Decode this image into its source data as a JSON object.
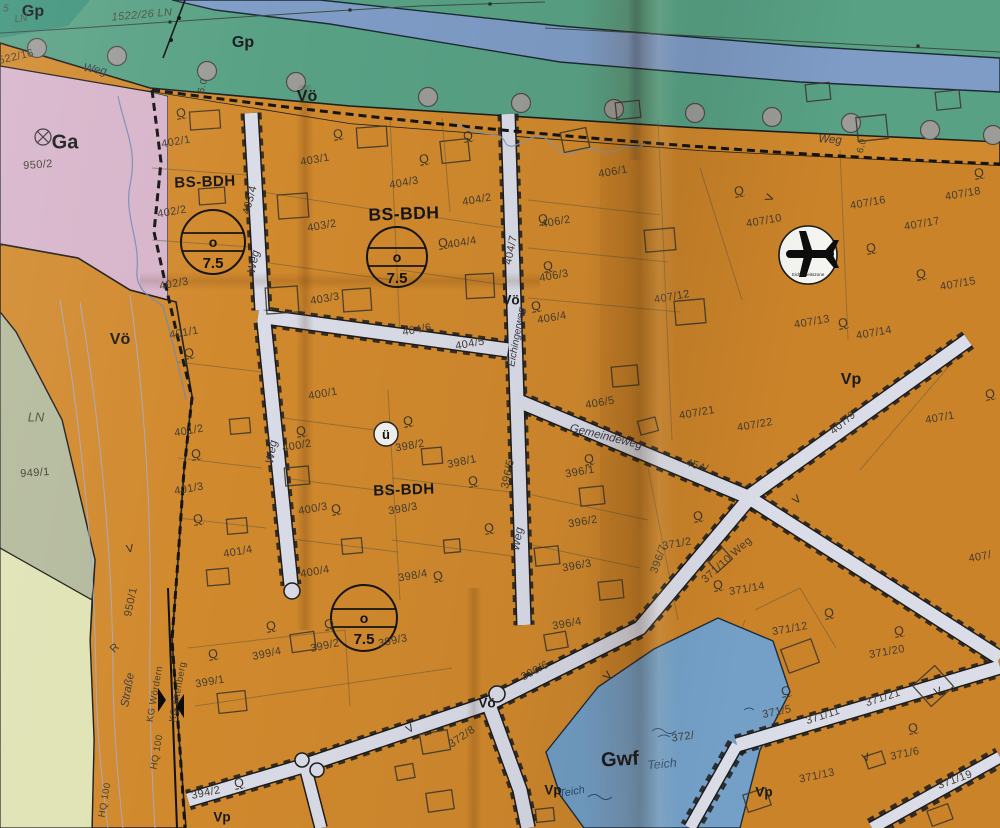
{
  "map_type": "Bebauungsplan / cadastral zoning map (paper, photographed)",
  "colors": {
    "green": "#58a185",
    "river": "#7e9cc6",
    "roadtop": "#e4e5e9",
    "pink": "#d7b4ca",
    "lav": "#c8cbdf",
    "ln1": "#b4ba9c",
    "ln2": "#dfe3b4",
    "orange": "#d1892d",
    "pond": "#74a0c8",
    "street": "#dadce8"
  },
  "symbols": {
    "airplane": {
      "x": 808,
      "y": 255,
      "r": 29,
      "caption": "Sicherheitszone"
    },
    "u_circle": {
      "x": 386,
      "y": 434,
      "r": 12,
      "text": "ü"
    },
    "use_templates": [
      {
        "x": 213,
        "y": 242,
        "r": 32,
        "mid": "o",
        "bottom": "7.5"
      },
      {
        "x": 397,
        "y": 257,
        "r": 30,
        "mid": "o",
        "bottom": "7.5"
      },
      {
        "x": 364,
        "y": 618,
        "r": 33,
        "mid": "o",
        "bottom": "7.5"
      }
    ]
  },
  "trees": [
    [
      37,
      48
    ],
    [
      117,
      56
    ],
    [
      207,
      71
    ],
    [
      296,
      82
    ],
    [
      428,
      97
    ],
    [
      521,
      103
    ],
    [
      614,
      109
    ],
    [
      695,
      113
    ],
    [
      772,
      117
    ],
    [
      851,
      123
    ],
    [
      930,
      130
    ],
    [
      993,
      135
    ]
  ],
  "labels": [
    {
      "t": "Gp",
      "x": 33,
      "y": 12,
      "r": 0,
      "c": "zb",
      "n": "zone-label-gp"
    },
    {
      "t": "Gp",
      "x": 243,
      "y": 43,
      "r": 0,
      "c": "zb",
      "n": "zone-label-gp"
    },
    {
      "t": "Vö",
      "x": 307,
      "y": 97,
      "r": 0,
      "c": "zb",
      "n": "zone-label-voe"
    },
    {
      "t": "Ga",
      "x": 65,
      "y": 143,
      "r": 0,
      "c": "zb zb-lg",
      "n": "zone-label-ga"
    },
    {
      "t": "Vö",
      "x": 120,
      "y": 340,
      "r": 0,
      "c": "zb",
      "n": "zone-label-voe"
    },
    {
      "t": "Vö",
      "x": 511,
      "y": 300,
      "r": 0,
      "c": "zb zb-sm",
      "n": "zone-label-voe"
    },
    {
      "t": "Vö",
      "x": 487,
      "y": 703,
      "r": 0,
      "c": "zb zb-sm",
      "n": "zone-label-voe"
    },
    {
      "t": "Vp",
      "x": 851,
      "y": 380,
      "r": 0,
      "c": "zb",
      "n": "zone-label-vp"
    },
    {
      "t": "Vp",
      "x": 764,
      "y": 792,
      "r": 0,
      "c": "zb zb-sm",
      "n": "zone-label-vp"
    },
    {
      "t": "Vp",
      "x": 553,
      "y": 790,
      "r": 0,
      "c": "zb zb-sm",
      "n": "zone-label-vp"
    },
    {
      "t": "Vp",
      "x": 222,
      "y": 817,
      "r": 0,
      "c": "zb zb-sm",
      "n": "zone-label-vp"
    },
    {
      "t": "Gwf",
      "x": 620,
      "y": 760,
      "r": -3,
      "c": "zb zb-lg",
      "n": "zone-label-gwf"
    },
    {
      "t": "BS-BDH",
      "x": 205,
      "y": 182,
      "r": -2,
      "c": "bs",
      "n": "zone-label-bs-bdh"
    },
    {
      "t": "BS-BDH",
      "x": 404,
      "y": 214,
      "r": -2,
      "c": "bs bs-lg",
      "n": "zone-label-bs-bdh"
    },
    {
      "t": "BS-BDH",
      "x": 404,
      "y": 490,
      "r": -2,
      "c": "bs",
      "n": "zone-label-bs-bdh"
    },
    {
      "t": "LN",
      "x": 36,
      "y": 417,
      "r": 0,
      "c": "ln",
      "n": "zone-label-ln"
    },
    {
      "t": "5",
      "x": 6,
      "y": 9,
      "r": 0,
      "c": "ln ln-sm",
      "n": "zone-label-ln"
    },
    {
      "t": "LN",
      "x": 21,
      "y": 19,
      "r": -8,
      "c": "ln ln-sm",
      "n": "zone-label-ln"
    },
    {
      "t": "1522/26 LN",
      "x": 142,
      "y": 15,
      "r": -5,
      "c": "p pi",
      "n": "parcel-label"
    },
    {
      "t": "522/16",
      "x": 16,
      "y": 57,
      "r": -13,
      "c": "p",
      "n": "parcel-label"
    },
    {
      "t": "950/2",
      "x": 38,
      "y": 165,
      "r": -4,
      "c": "p",
      "n": "parcel-label"
    },
    {
      "t": "949/1",
      "x": 35,
      "y": 473,
      "r": -4,
      "c": "p",
      "n": "parcel-label"
    },
    {
      "t": "950/1",
      "x": 131,
      "y": 602,
      "r": -78,
      "c": "p",
      "n": "parcel-label"
    },
    {
      "t": "Straße",
      "x": 128,
      "y": 690,
      "r": -80,
      "c": "sn",
      "n": "street-name"
    },
    {
      "t": "R",
      "x": 115,
      "y": 648,
      "r": -45,
      "c": "p",
      "n": "parcel-label"
    },
    {
      "t": "HQ 100",
      "x": 157,
      "y": 752,
      "r": -80,
      "c": "p psm",
      "n": "flood-line-label"
    },
    {
      "t": "HQ 100",
      "x": 105,
      "y": 800,
      "r": -80,
      "c": "p psm",
      "n": "flood-line-label"
    },
    {
      "t": "KG Wördern",
      "x": 155,
      "y": 694,
      "r": -80,
      "c": "p psm",
      "n": "cadastral-boundary-label"
    },
    {
      "t": "KG Altenberg",
      "x": 178,
      "y": 692,
      "r": -80,
      "c": "p psm",
      "n": "cadastral-boundary-label"
    },
    {
      "t": "Weg",
      "x": 95,
      "y": 70,
      "r": 10,
      "c": "sn",
      "n": "street-name"
    },
    {
      "t": "Weg",
      "x": 830,
      "y": 140,
      "r": 4,
      "c": "sn",
      "n": "street-name"
    },
    {
      "t": "6.0",
      "x": 203,
      "y": 86,
      "r": -75,
      "c": "p psm",
      "n": "dimension-label"
    },
    {
      "t": "6.0",
      "x": 862,
      "y": 146,
      "r": -75,
      "c": "p psm",
      "n": "dimension-label"
    },
    {
      "t": "402/1",
      "x": 176,
      "y": 142,
      "r": -10,
      "c": "p",
      "n": "parcel-label"
    },
    {
      "t": "402/2",
      "x": 172,
      "y": 212,
      "r": -10,
      "c": "p",
      "n": "parcel-label"
    },
    {
      "t": "402/3",
      "x": 174,
      "y": 284,
      "r": -10,
      "c": "p",
      "n": "parcel-label"
    },
    {
      "t": "403/4",
      "x": 250,
      "y": 200,
      "r": -75,
      "c": "p",
      "n": "parcel-label"
    },
    {
      "t": "Weg",
      "x": 254,
      "y": 262,
      "r": -78,
      "c": "sn",
      "n": "street-name"
    },
    {
      "t": "401/1",
      "x": 184,
      "y": 333,
      "r": -10,
      "c": "p",
      "n": "parcel-label"
    },
    {
      "t": "401/2",
      "x": 189,
      "y": 431,
      "r": -10,
      "c": "p",
      "n": "parcel-label"
    },
    {
      "t": "401/3",
      "x": 189,
      "y": 489,
      "r": -10,
      "c": "p",
      "n": "parcel-label"
    },
    {
      "t": "401/4",
      "x": 238,
      "y": 552,
      "r": -10,
      "c": "p",
      "n": "parcel-label"
    },
    {
      "t": "Weg",
      "x": 272,
      "y": 452,
      "r": -80,
      "c": "sn",
      "n": "street-name"
    },
    {
      "t": "403/1",
      "x": 315,
      "y": 160,
      "r": -10,
      "c": "p",
      "n": "parcel-label"
    },
    {
      "t": "403/2",
      "x": 322,
      "y": 226,
      "r": -10,
      "c": "p",
      "n": "parcel-label"
    },
    {
      "t": "403/3",
      "x": 325,
      "y": 299,
      "r": -10,
      "c": "p",
      "n": "parcel-label"
    },
    {
      "t": "404/3",
      "x": 404,
      "y": 183,
      "r": -10,
      "c": "p",
      "n": "parcel-label"
    },
    {
      "t": "404/2",
      "x": 477,
      "y": 200,
      "r": -10,
      "c": "p",
      "n": "parcel-label"
    },
    {
      "t": "404/4",
      "x": 462,
      "y": 243,
      "r": -10,
      "c": "p",
      "n": "parcel-label"
    },
    {
      "t": "404/6",
      "x": 417,
      "y": 330,
      "r": -10,
      "c": "p",
      "n": "parcel-label"
    },
    {
      "t": "404/5",
      "x": 470,
      "y": 344,
      "r": -10,
      "c": "p",
      "n": "parcel-label"
    },
    {
      "t": "404/7",
      "x": 511,
      "y": 250,
      "r": -78,
      "c": "p",
      "n": "parcel-label"
    },
    {
      "t": "Eichingerweg",
      "x": 517,
      "y": 337,
      "r": -80,
      "c": "sn sn-sm",
      "n": "street-name"
    },
    {
      "t": "406/1",
      "x": 613,
      "y": 172,
      "r": -10,
      "c": "p",
      "n": "parcel-label"
    },
    {
      "t": "406/2",
      "x": 556,
      "y": 222,
      "r": -10,
      "c": "p",
      "n": "parcel-label"
    },
    {
      "t": "406/3",
      "x": 554,
      "y": 276,
      "r": -10,
      "c": "p",
      "n": "parcel-label"
    },
    {
      "t": "406/4",
      "x": 552,
      "y": 318,
      "r": -10,
      "c": "p",
      "n": "parcel-label"
    },
    {
      "t": "406/5",
      "x": 600,
      "y": 403,
      "r": -10,
      "c": "p",
      "n": "parcel-label"
    },
    {
      "t": "407/12",
      "x": 672,
      "y": 297,
      "r": -10,
      "c": "p",
      "n": "parcel-label"
    },
    {
      "t": "407/10",
      "x": 764,
      "y": 221,
      "r": -10,
      "c": "p",
      "n": "parcel-label"
    },
    {
      "t": "407/16",
      "x": 868,
      "y": 203,
      "r": -10,
      "c": "p",
      "n": "parcel-label"
    },
    {
      "t": "407/17",
      "x": 922,
      "y": 224,
      "r": -10,
      "c": "p",
      "n": "parcel-label"
    },
    {
      "t": "407/18",
      "x": 963,
      "y": 194,
      "r": -10,
      "c": "p",
      "n": "parcel-label"
    },
    {
      "t": "407/15",
      "x": 958,
      "y": 284,
      "r": -10,
      "c": "p",
      "n": "parcel-label"
    },
    {
      "t": "407/13",
      "x": 812,
      "y": 322,
      "r": -10,
      "c": "p",
      "n": "parcel-label"
    },
    {
      "t": "407/14",
      "x": 874,
      "y": 333,
      "r": -10,
      "c": "p",
      "n": "parcel-label"
    },
    {
      "t": "407/1",
      "x": 940,
      "y": 418,
      "r": -10,
      "c": "p",
      "n": "parcel-label"
    },
    {
      "t": "407/21",
      "x": 697,
      "y": 413,
      "r": -10,
      "c": "p",
      "n": "parcel-label"
    },
    {
      "t": "407/22",
      "x": 755,
      "y": 425,
      "r": -10,
      "c": "p",
      "n": "parcel-label"
    },
    {
      "t": "407/9",
      "x": 843,
      "y": 423,
      "r": -40,
      "c": "p",
      "n": "parcel-label"
    },
    {
      "t": "407/",
      "x": 980,
      "y": 557,
      "r": -10,
      "c": "p",
      "n": "parcel-label"
    },
    {
      "t": "Gemeindeweg",
      "x": 606,
      "y": 437,
      "r": 14,
      "c": "sn",
      "n": "street-name"
    },
    {
      "t": "454/",
      "x": 697,
      "y": 466,
      "r": 18,
      "c": "p",
      "n": "parcel-label"
    },
    {
      "t": "398/1",
      "x": 462,
      "y": 462,
      "r": -12,
      "c": "p",
      "n": "parcel-label"
    },
    {
      "t": "398/2",
      "x": 410,
      "y": 446,
      "r": -10,
      "c": "p",
      "n": "parcel-label"
    },
    {
      "t": "398/3",
      "x": 403,
      "y": 509,
      "r": -10,
      "c": "p",
      "n": "parcel-label"
    },
    {
      "t": "398/4",
      "x": 413,
      "y": 576,
      "r": -10,
      "c": "p",
      "n": "parcel-label"
    },
    {
      "t": "400/1",
      "x": 323,
      "y": 394,
      "r": -10,
      "c": "p",
      "n": "parcel-label"
    },
    {
      "t": "400/2",
      "x": 297,
      "y": 446,
      "r": -10,
      "c": "p",
      "n": "parcel-label"
    },
    {
      "t": "400/3",
      "x": 313,
      "y": 509,
      "r": -10,
      "c": "p",
      "n": "parcel-label"
    },
    {
      "t": "400/4",
      "x": 315,
      "y": 572,
      "r": -10,
      "c": "p",
      "n": "parcel-label"
    },
    {
      "t": "396/5",
      "x": 508,
      "y": 474,
      "r": -78,
      "c": "p",
      "n": "parcel-label"
    },
    {
      "t": "Weg",
      "x": 518,
      "y": 539,
      "r": -80,
      "c": "sn",
      "n": "street-name"
    },
    {
      "t": "396/1",
      "x": 580,
      "y": 472,
      "r": -10,
      "c": "p",
      "n": "parcel-label"
    },
    {
      "t": "396/2",
      "x": 583,
      "y": 522,
      "r": -10,
      "c": "p",
      "n": "parcel-label"
    },
    {
      "t": "396/3",
      "x": 577,
      "y": 566,
      "r": -10,
      "c": "p",
      "n": "parcel-label"
    },
    {
      "t": "396/4",
      "x": 567,
      "y": 624,
      "r": -10,
      "c": "p",
      "n": "parcel-label"
    },
    {
      "t": "396/7",
      "x": 659,
      "y": 559,
      "r": -70,
      "c": "p",
      "n": "parcel-label"
    },
    {
      "t": "371/2",
      "x": 677,
      "y": 544,
      "r": -10,
      "c": "p",
      "n": "parcel-label"
    },
    {
      "t": "371/10 Weg",
      "x": 727,
      "y": 560,
      "r": -42,
      "c": "p",
      "n": "street-name"
    },
    {
      "t": "371/14",
      "x": 747,
      "y": 589,
      "r": -10,
      "c": "p",
      "n": "parcel-label"
    },
    {
      "t": "371/12",
      "x": 790,
      "y": 629,
      "r": -10,
      "c": "p",
      "n": "parcel-label"
    },
    {
      "t": "371/20",
      "x": 887,
      "y": 652,
      "r": -10,
      "c": "p",
      "n": "parcel-label"
    },
    {
      "t": "371/21",
      "x": 883,
      "y": 698,
      "r": -18,
      "c": "p",
      "n": "parcel-label"
    },
    {
      "t": "371/11",
      "x": 823,
      "y": 716,
      "r": -18,
      "c": "p",
      "n": "parcel-label"
    },
    {
      "t": "371/5",
      "x": 777,
      "y": 712,
      "r": -12,
      "c": "p",
      "n": "parcel-label"
    },
    {
      "t": "371/6",
      "x": 905,
      "y": 754,
      "r": -12,
      "c": "p",
      "n": "parcel-label"
    },
    {
      "t": "371/13",
      "x": 817,
      "y": 776,
      "r": -12,
      "c": "p",
      "n": "parcel-label"
    },
    {
      "t": "371/19",
      "x": 955,
      "y": 780,
      "r": -20,
      "c": "p",
      "n": "parcel-label"
    },
    {
      "t": "372/",
      "x": 683,
      "y": 737,
      "r": -8,
      "c": "p",
      "n": "parcel-label"
    },
    {
      "t": "372/8",
      "x": 462,
      "y": 737,
      "r": -35,
      "c": "p",
      "n": "parcel-label"
    },
    {
      "t": "390/6",
      "x": 535,
      "y": 671,
      "r": -28,
      "c": "p",
      "n": "parcel-label"
    },
    {
      "t": "394/2",
      "x": 206,
      "y": 793,
      "r": -12,
      "c": "p",
      "n": "parcel-label"
    },
    {
      "t": "399/1",
      "x": 210,
      "y": 682,
      "r": -10,
      "c": "p",
      "n": "parcel-label"
    },
    {
      "t": "399/2",
      "x": 325,
      "y": 646,
      "r": -12,
      "c": "p",
      "n": "parcel-label"
    },
    {
      "t": "399/3",
      "x": 393,
      "y": 641,
      "r": -12,
      "c": "p",
      "n": "parcel-label"
    },
    {
      "t": "399/4",
      "x": 267,
      "y": 654,
      "r": -12,
      "c": "p",
      "n": "parcel-label"
    },
    {
      "t": "Teich",
      "x": 662,
      "y": 764,
      "r": -5,
      "c": "wt",
      "n": "water-label"
    },
    {
      "t": "Teich",
      "x": 572,
      "y": 792,
      "r": -10,
      "c": "wt wt-sm",
      "n": "water-label"
    },
    {
      "t": "V",
      "x": 130,
      "y": 549,
      "r": -10,
      "c": "vm",
      "n": "survey-mark"
    },
    {
      "t": "V",
      "x": 797,
      "y": 500,
      "r": -40,
      "c": "vm",
      "n": "survey-mark"
    },
    {
      "t": "V",
      "x": 938,
      "y": 692,
      "r": -18,
      "c": "vm",
      "n": "survey-mark"
    },
    {
      "t": "V",
      "x": 866,
      "y": 758,
      "r": -18,
      "c": "vm",
      "n": "survey-mark"
    },
    {
      "t": "V",
      "x": 410,
      "y": 729,
      "r": -30,
      "c": "vm",
      "n": "survey-mark"
    },
    {
      "t": "V",
      "x": 770,
      "y": 198,
      "r": -70,
      "c": "vm",
      "n": "survey-mark"
    },
    {
      "t": "V",
      "x": 608,
      "y": 676,
      "r": -50,
      "c": "vm",
      "n": "survey-mark"
    },
    {
      "t": "Q",
      "x": 181,
      "y": 113,
      "r": -12,
      "c": "q",
      "n": "tree-symbol"
    },
    {
      "t": "Q",
      "x": 338,
      "y": 134,
      "r": -12,
      "c": "q",
      "n": "tree-symbol"
    },
    {
      "t": "Q",
      "x": 424,
      "y": 159,
      "r": -12,
      "c": "q",
      "n": "tree-symbol"
    },
    {
      "t": "Q",
      "x": 468,
      "y": 136,
      "r": -12,
      "c": "q",
      "n": "tree-symbol"
    },
    {
      "t": "Q",
      "x": 443,
      "y": 243,
      "r": -12,
      "c": "q",
      "n": "tree-symbol"
    },
    {
      "t": "Q",
      "x": 543,
      "y": 219,
      "r": -12,
      "c": "q",
      "n": "tree-symbol"
    },
    {
      "t": "Q",
      "x": 548,
      "y": 266,
      "r": -12,
      "c": "q",
      "n": "tree-symbol"
    },
    {
      "t": "Q",
      "x": 536,
      "y": 306,
      "r": -12,
      "c": "q",
      "n": "tree-symbol"
    },
    {
      "t": "Q",
      "x": 739,
      "y": 191,
      "r": -12,
      "c": "q",
      "n": "tree-symbol"
    },
    {
      "t": "Q",
      "x": 871,
      "y": 248,
      "r": -12,
      "c": "q",
      "n": "tree-symbol"
    },
    {
      "t": "Q",
      "x": 921,
      "y": 274,
      "r": -12,
      "c": "q",
      "n": "tree-symbol"
    },
    {
      "t": "Q",
      "x": 843,
      "y": 323,
      "r": -12,
      "c": "q",
      "n": "tree-symbol"
    },
    {
      "t": "Q",
      "x": 189,
      "y": 353,
      "r": -12,
      "c": "q",
      "n": "tree-symbol"
    },
    {
      "t": "Q",
      "x": 196,
      "y": 454,
      "r": -12,
      "c": "q",
      "n": "tree-symbol"
    },
    {
      "t": "Q",
      "x": 198,
      "y": 519,
      "r": -12,
      "c": "q",
      "n": "tree-symbol"
    },
    {
      "t": "Q",
      "x": 301,
      "y": 431,
      "r": -12,
      "c": "q",
      "n": "tree-symbol"
    },
    {
      "t": "Q",
      "x": 408,
      "y": 421,
      "r": -12,
      "c": "q",
      "n": "tree-symbol"
    },
    {
      "t": "Q",
      "x": 336,
      "y": 509,
      "r": -12,
      "c": "q",
      "n": "tree-symbol"
    },
    {
      "t": "Q",
      "x": 473,
      "y": 481,
      "r": -12,
      "c": "q",
      "n": "tree-symbol"
    },
    {
      "t": "Q",
      "x": 438,
      "y": 576,
      "r": -12,
      "c": "q",
      "n": "tree-symbol"
    },
    {
      "t": "Q",
      "x": 489,
      "y": 528,
      "r": -12,
      "c": "q",
      "n": "tree-symbol"
    },
    {
      "t": "Q",
      "x": 589,
      "y": 459,
      "r": -12,
      "c": "q",
      "n": "tree-symbol"
    },
    {
      "t": "Q",
      "x": 698,
      "y": 516,
      "r": -12,
      "c": "q",
      "n": "tree-symbol"
    },
    {
      "t": "Q",
      "x": 718,
      "y": 585,
      "r": -12,
      "c": "q",
      "n": "tree-symbol"
    },
    {
      "t": "Q",
      "x": 271,
      "y": 626,
      "r": -12,
      "c": "q",
      "n": "tree-symbol"
    },
    {
      "t": "Q",
      "x": 329,
      "y": 624,
      "r": -12,
      "c": "q",
      "n": "tree-symbol"
    },
    {
      "t": "Q",
      "x": 213,
      "y": 654,
      "r": -12,
      "c": "q",
      "n": "tree-symbol"
    },
    {
      "t": "Q",
      "x": 239,
      "y": 783,
      "r": -12,
      "c": "q",
      "n": "tree-symbol"
    },
    {
      "t": "Q",
      "x": 829,
      "y": 613,
      "r": -12,
      "c": "q",
      "n": "tree-symbol"
    },
    {
      "t": "Q",
      "x": 899,
      "y": 631,
      "r": -12,
      "c": "q",
      "n": "tree-symbol"
    },
    {
      "t": "Q",
      "x": 913,
      "y": 728,
      "r": -12,
      "c": "q",
      "n": "tree-symbol"
    },
    {
      "t": "Q",
      "x": 786,
      "y": 691,
      "r": -12,
      "c": "q",
      "n": "tree-symbol"
    },
    {
      "t": "Q",
      "x": 979,
      "y": 173,
      "r": -12,
      "c": "q",
      "n": "tree-symbol"
    },
    {
      "t": "Q",
      "x": 990,
      "y": 394,
      "r": -12,
      "c": "q",
      "n": "tree-symbol"
    }
  ]
}
